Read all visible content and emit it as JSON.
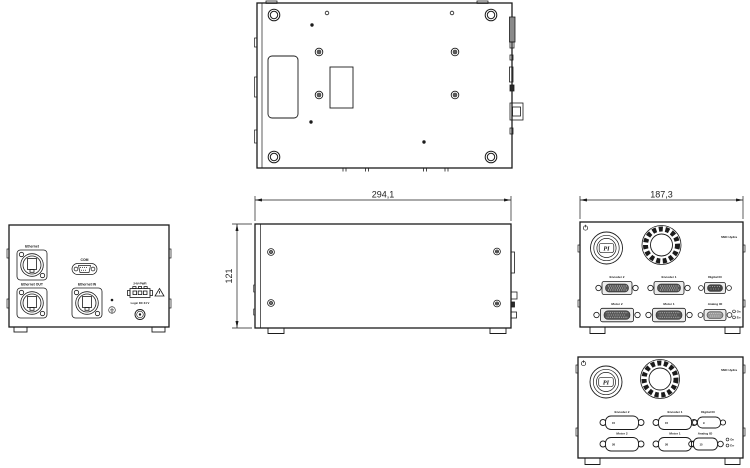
{
  "dims": {
    "width": "294,1",
    "height": "121",
    "depth": "187,3"
  },
  "rear": {
    "ethernet": "Ethernet",
    "com": "COM",
    "ethernet_out": "Ethernet OUT",
    "ethernet_in": "Ethernet IN",
    "pwr": "24V-PWR",
    "logic": "Logic DC 24 V"
  },
  "front": {
    "model": "SMC Hydra",
    "logo": "PI",
    "encoder2": "Encoder 2",
    "encoder1": "Encoder 1",
    "digital": "Digital IO",
    "motor2": "Motor 2",
    "motor1": "Motor 1",
    "analog": "Analog IO",
    "ind_on": "On",
    "ind_err": "Err",
    "pins": {
      "encoder": "15",
      "digital": "9",
      "motor": "26",
      "analog": "15"
    }
  },
  "colors": {
    "line": "#1b1b1b",
    "gray_fill": "#8a8a8a",
    "dark_fill": "#3a3a3a",
    "bg": "#ffffff"
  }
}
